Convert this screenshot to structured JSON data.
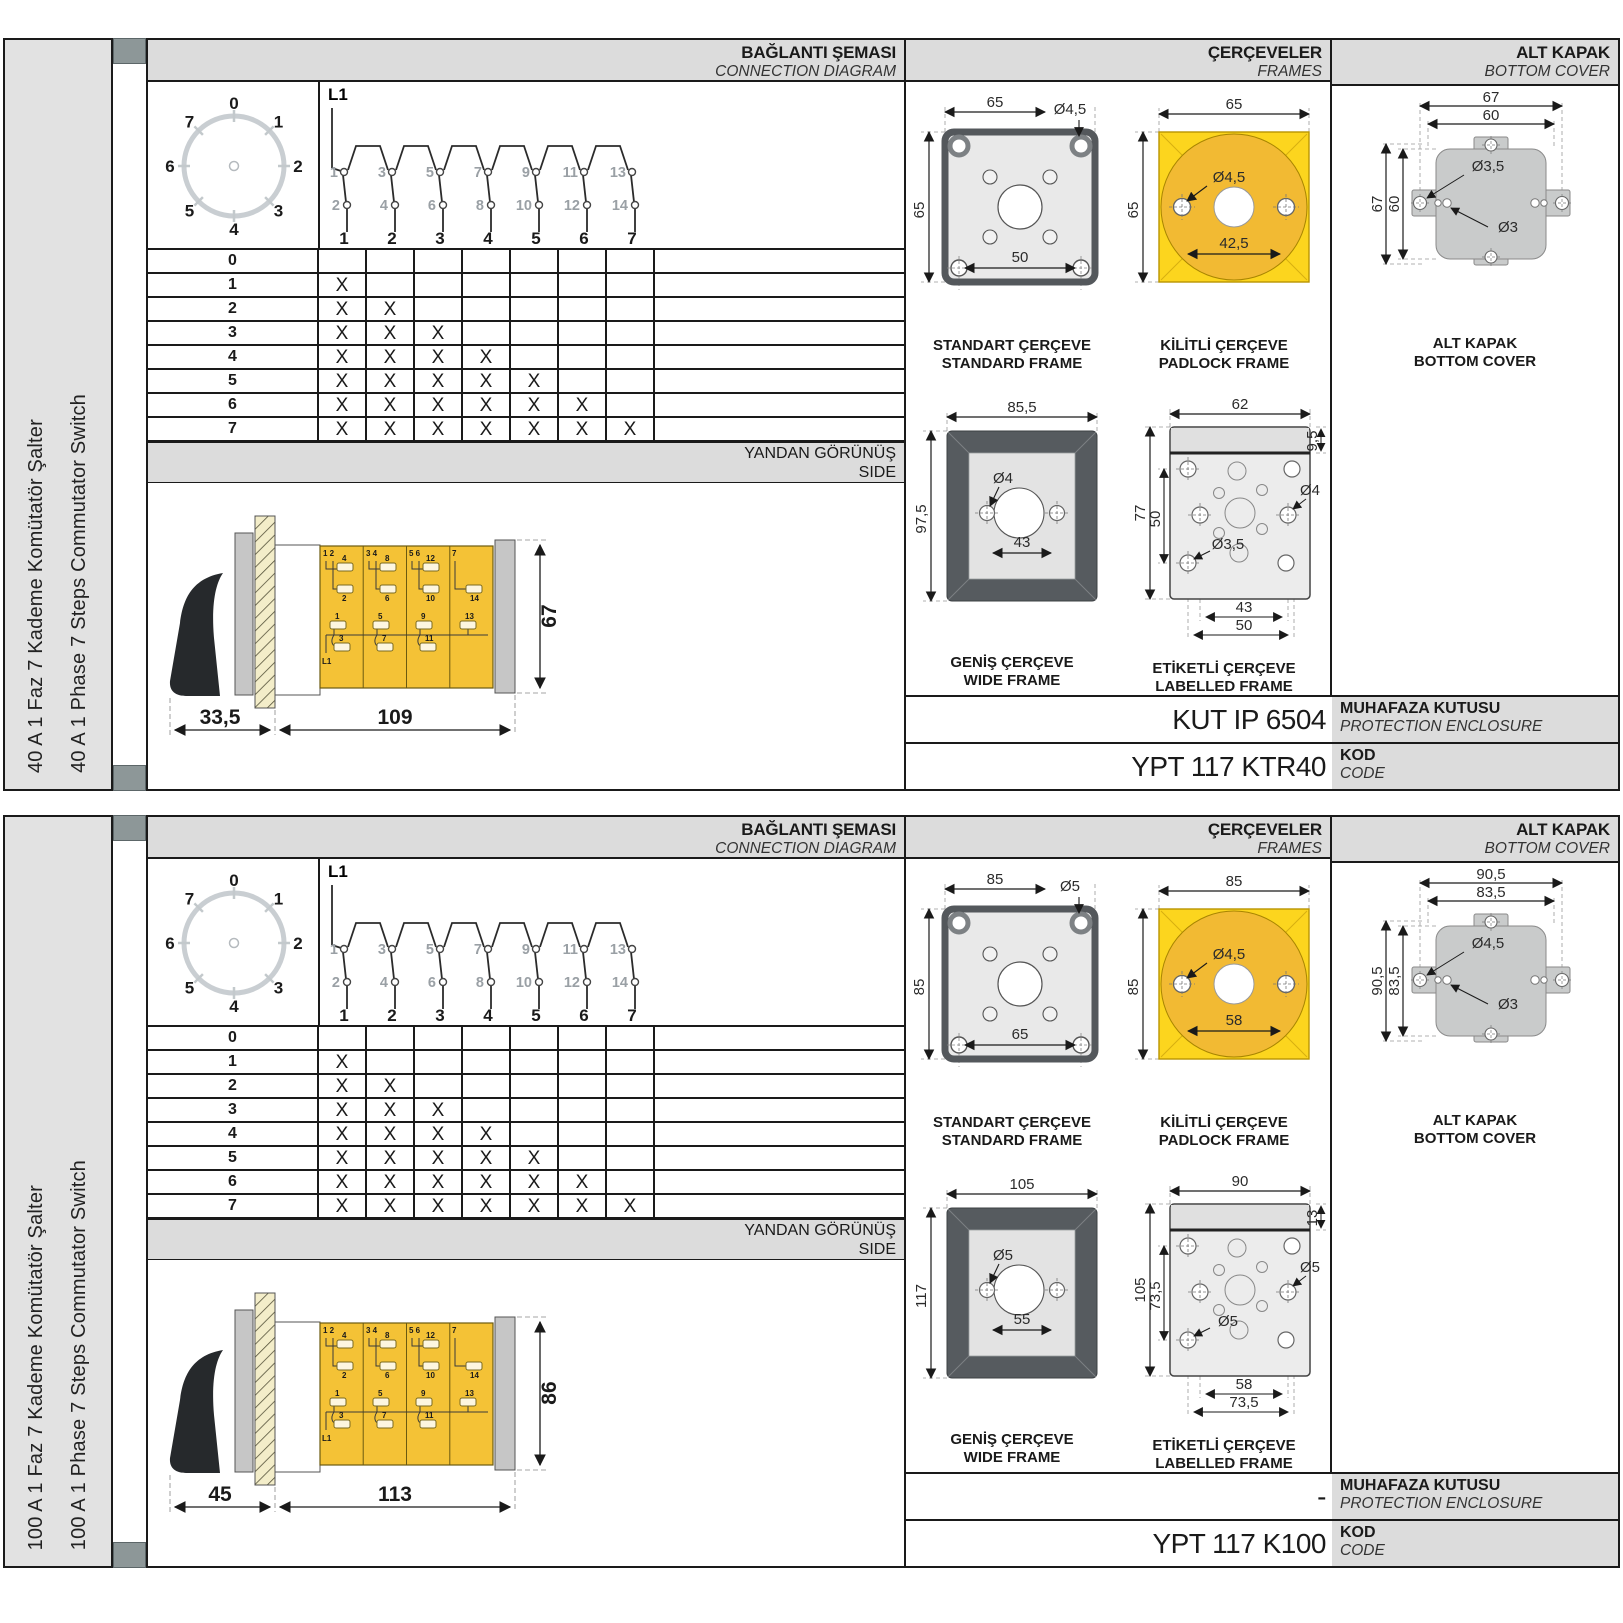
{
  "shared": {
    "headers": {
      "connection_tr": "BAĞLANTI ŞEMASI",
      "connection_en": "CONNECTION DIAGRAM",
      "frames_tr": "ÇERÇEVELER",
      "frames_en": "FRAMES",
      "cover_tr": "ALT KAPAK",
      "cover_en": "BOTTOM COVER",
      "side_tr": "YANDAN GÖRÜNÜŞ",
      "side_en": "SIDE",
      "enclosure_tr": "MUHAFAZA KUTUSU",
      "enclosure_en": "PROTECTION ENCLOSURE",
      "code_tr": "KOD",
      "code_en": "CODE"
    },
    "dial": {
      "positions": [
        "0",
        "1",
        "2",
        "3",
        "4",
        "5",
        "6",
        "7"
      ]
    },
    "schematic": {
      "phase": "L1",
      "top_contacts": [
        "1",
        "3",
        "5",
        "7",
        "9",
        "11",
        "13"
      ],
      "bottom_contacts": [
        "2",
        "4",
        "6",
        "8",
        "10",
        "12",
        "14"
      ],
      "steps": [
        "1",
        "2",
        "3",
        "4",
        "5",
        "6",
        "7"
      ]
    },
    "step_table": {
      "rows": [
        {
          "label": "0",
          "marks": [
            "",
            "",
            "",
            "",
            "",
            "",
            ""
          ]
        },
        {
          "label": "1",
          "marks": [
            "X",
            "",
            "",
            "",
            "",
            "",
            ""
          ]
        },
        {
          "label": "2",
          "marks": [
            "X",
            "X",
            "",
            "",
            "",
            "",
            ""
          ]
        },
        {
          "label": "3",
          "marks": [
            "X",
            "X",
            "X",
            "",
            "",
            "",
            ""
          ]
        },
        {
          "label": "4",
          "marks": [
            "X",
            "X",
            "X",
            "X",
            "",
            "",
            ""
          ]
        },
        {
          "label": "5",
          "marks": [
            "X",
            "X",
            "X",
            "X",
            "X",
            "",
            ""
          ]
        },
        {
          "label": "6",
          "marks": [
            "X",
            "X",
            "X",
            "X",
            "X",
            "X",
            ""
          ]
        },
        {
          "label": "7",
          "marks": [
            "X",
            "X",
            "X",
            "X",
            "X",
            "X",
            "X"
          ]
        }
      ]
    },
    "side_view": {
      "seg1_top": "1  2",
      "seg2_top": "3  4",
      "seg3_top": "5  6",
      "seg4_top": "7",
      "t1": "1",
      "t2": "2",
      "t3": "3",
      "t4": "4",
      "t5": "5",
      "t6": "6",
      "t7": "7",
      "t8": "8",
      "t9": "9",
      "t10": "10",
      "t11": "11",
      "t12": "12",
      "t13": "13",
      "t14": "14",
      "l1": "L1"
    },
    "frame_captions": {
      "standard_tr": "STANDART ÇERÇEVE",
      "standard_en": "STANDARD FRAME",
      "padlock_tr": "KİLİTLİ ÇERÇEVE",
      "padlock_en": "PADLOCK FRAME",
      "wide_tr": "GENİŞ ÇERÇEVE",
      "wide_en": "WIDE FRAME",
      "labelled_tr": "ETİKETLİ ÇERÇEVE",
      "labelled_en": "LABELLED FRAME",
      "cover_tr": "ALT KAPAK",
      "cover_en": "BOTTOM COVER"
    },
    "colors": {
      "accent_yellow": "#f4c236",
      "padlock_yellow": "#fcd51e",
      "padlock_circle": "#f2ba33",
      "frame_dark": "#565b5f",
      "band_gray": "#dcdcdc"
    }
  },
  "sections": [
    {
      "sidebar_tr": "40 A 1 Faz 7 Kademe Komütatör Şalter",
      "sidebar_en": "40 A 1 Phase 7 Steps Commutator Switch",
      "side_view": {
        "handle_len": "33,5",
        "body_len": "109",
        "height": "67"
      },
      "frames": {
        "standard": {
          "w": "65",
          "h": "65",
          "hole": "Ø4,5",
          "pitch": "50"
        },
        "padlock": {
          "w": "65",
          "h": "65",
          "hole": "Ø4,5",
          "pitch": "42,5"
        },
        "wide": {
          "w": "85,5",
          "h": "97,5",
          "hole": "Ø4",
          "pitch": "43"
        },
        "labelled": {
          "w": "62",
          "h": "77",
          "band": "9,5",
          "inner_h": "50",
          "hole_right": "Ø4",
          "hole_left": "Ø3,5",
          "pitch1": "43",
          "pitch2": "50"
        }
      },
      "cover": {
        "outer_w": "67",
        "inner_w": "60",
        "outer_h": "67",
        "inner_h": "60",
        "hole_big": "Ø3,5",
        "hole_small": "Ø3"
      },
      "enclosure_value": "KUT IP 6504",
      "code_value": "YPT 117 KTR40"
    },
    {
      "sidebar_tr": "100 A 1 Faz 7 Kademe Komütatör Şalter",
      "sidebar_en": "100 A 1 Phase 7 Steps Commutator Switch",
      "side_view": {
        "handle_len": "45",
        "body_len": "113",
        "height": "86"
      },
      "frames": {
        "standard": {
          "w": "85",
          "h": "85",
          "hole": "Ø5",
          "pitch": "65"
        },
        "padlock": {
          "w": "85",
          "h": "85",
          "hole": "Ø4,5",
          "pitch": "58"
        },
        "wide": {
          "w": "105",
          "h": "117",
          "hole": "Ø5",
          "pitch": "55"
        },
        "labelled": {
          "w": "90",
          "h": "105",
          "band": "13",
          "inner_h": "73,5",
          "hole_right": "Ø5",
          "hole_left": "Ø5",
          "pitch1": "58",
          "pitch2": "73,5"
        }
      },
      "cover": {
        "outer_w": "90,5",
        "inner_w": "83,5",
        "outer_h": "90,5",
        "inner_h": "83,5",
        "hole_big": "Ø4,5",
        "hole_small": "Ø3"
      },
      "enclosure_value": "-",
      "code_value": "YPT 117 K100"
    }
  ]
}
